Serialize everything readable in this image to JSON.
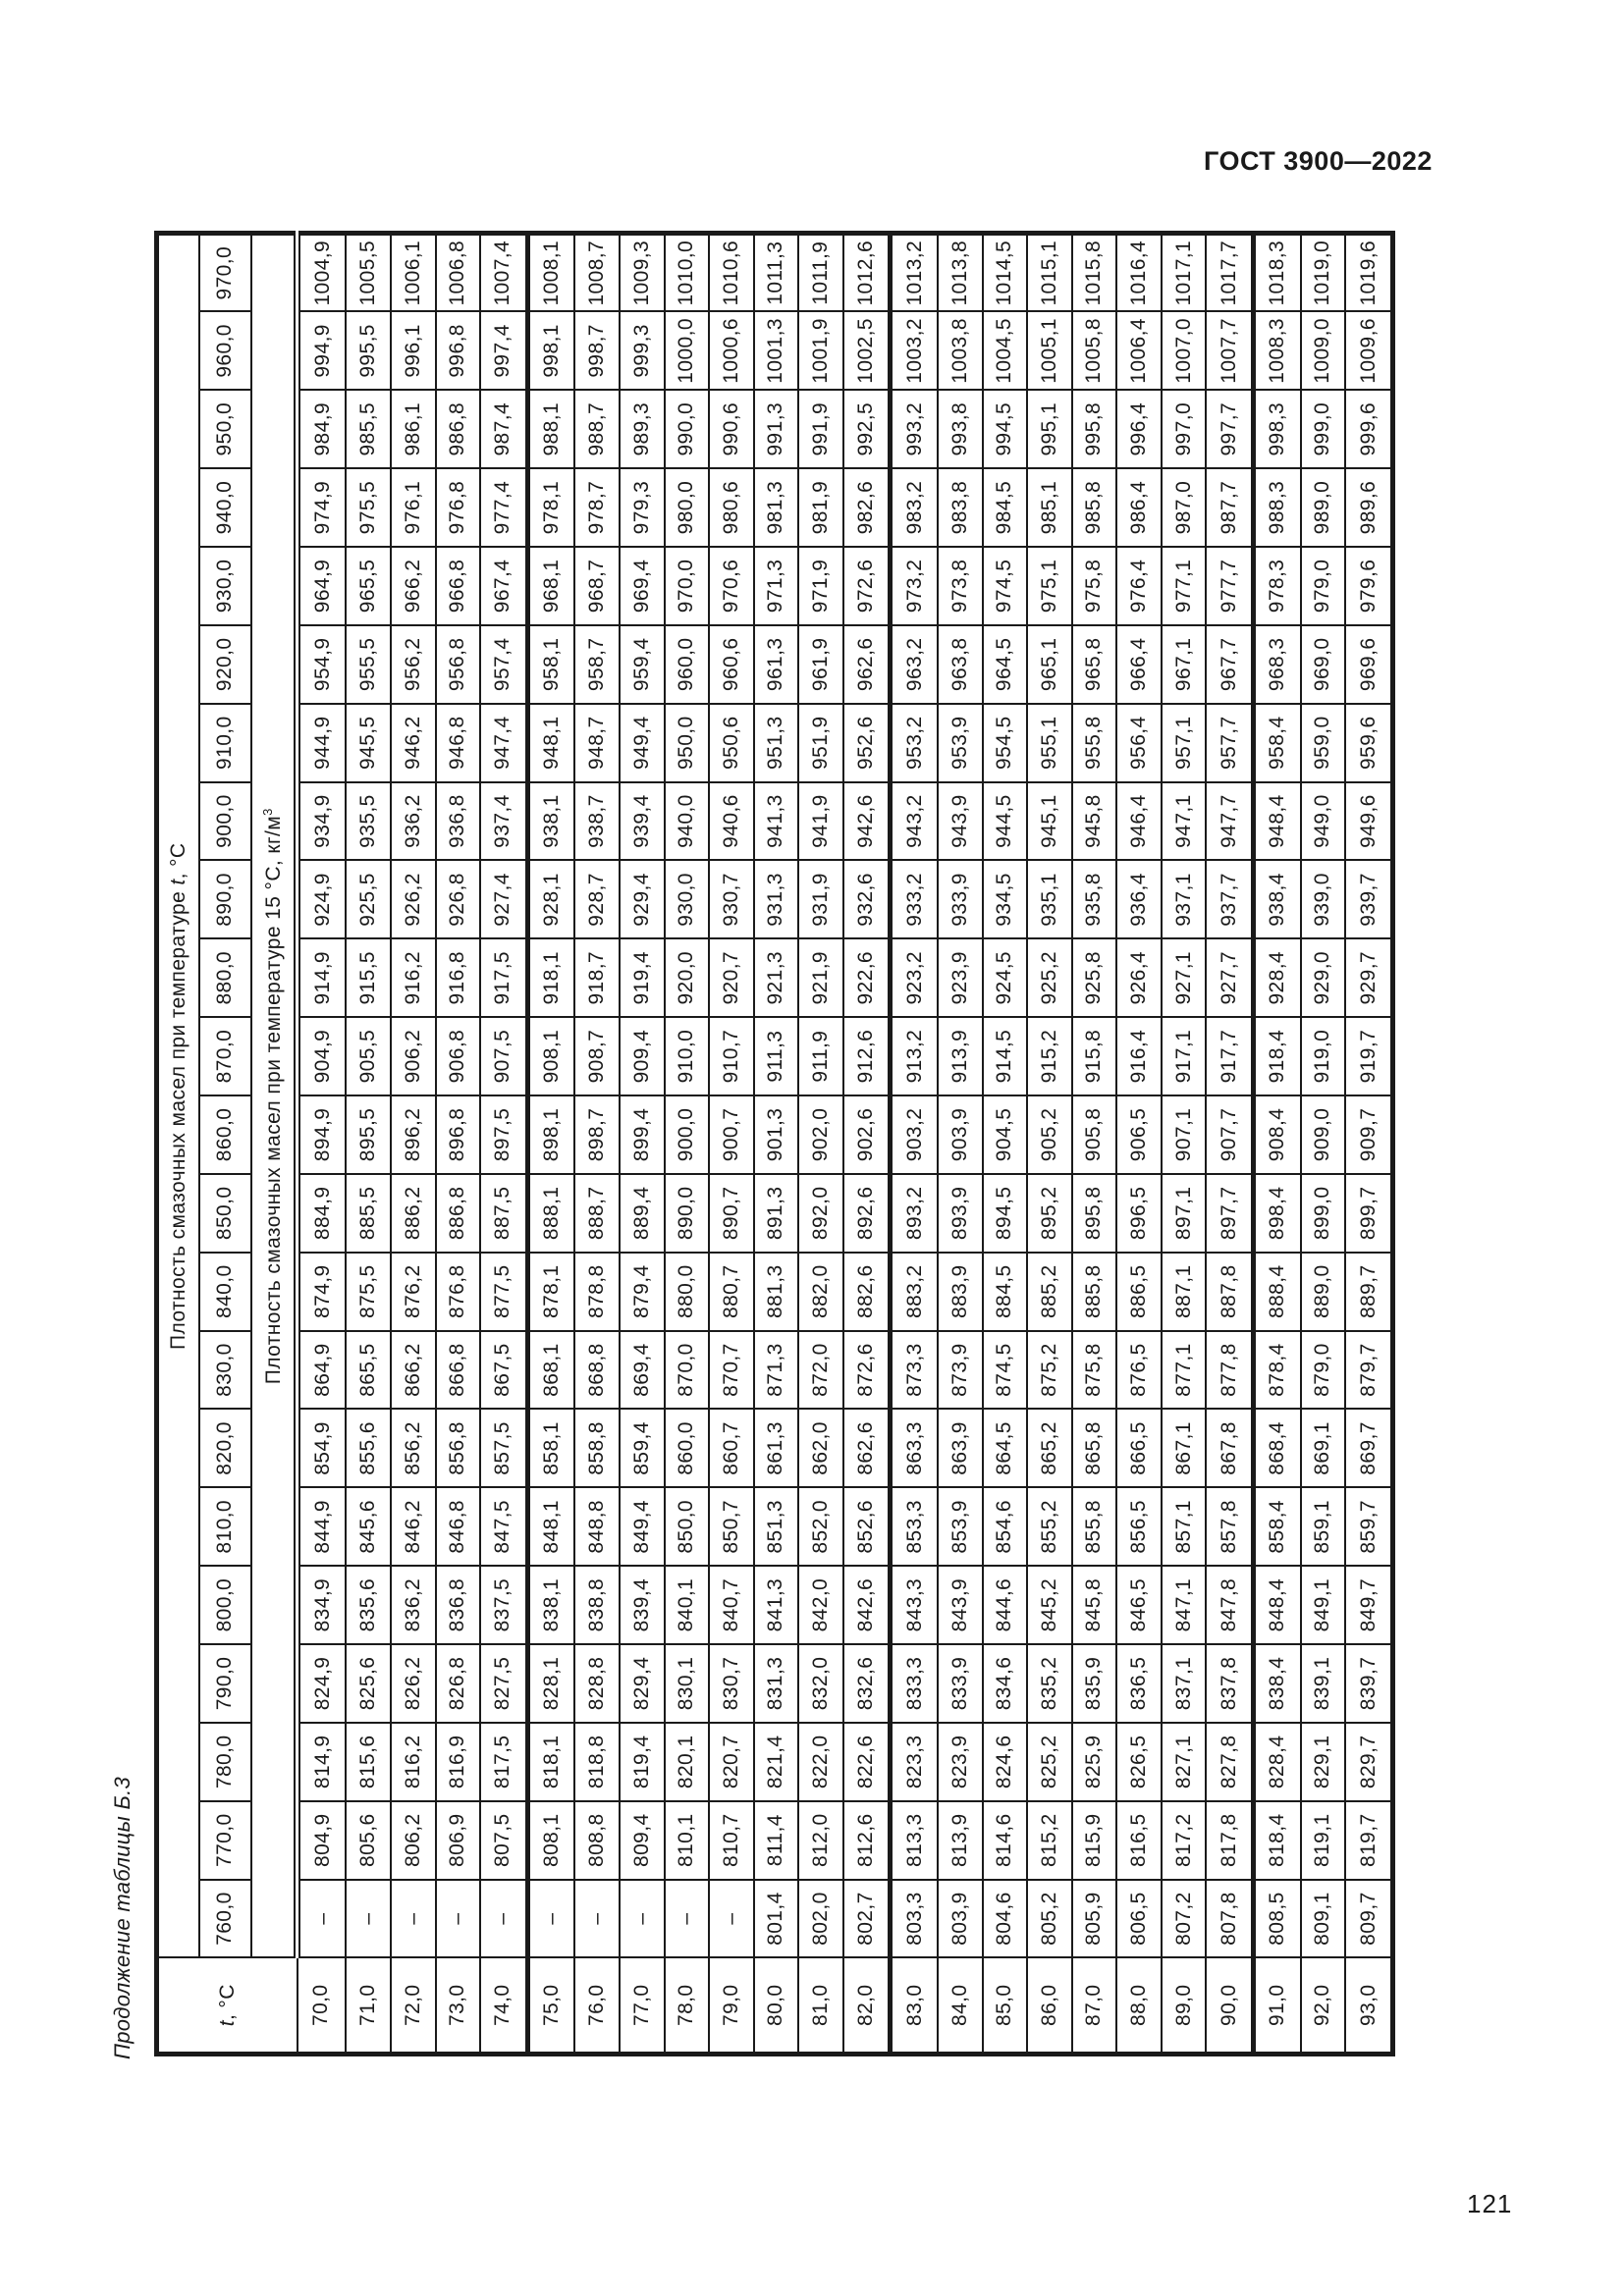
{
  "page": {
    "designation": "ГОСТ 3900—2022",
    "continuation": "Продолжение таблицы Б.3",
    "page_number": "121"
  },
  "table": {
    "stub_t": "t",
    "stub_rest": ", °С",
    "header_top_prefix": "Плотность смазочных масел при температуре ",
    "header_top_t": "t",
    "header_top_suffix": ", °С",
    "header_bottom_text": "Плотность смазочных масел при температуре 15 °С, кг/м",
    "header_bottom_sup": "3",
    "density_columns": [
      "760,0",
      "770,0",
      "780,0",
      "790,0",
      "800,0",
      "810,0",
      "820,0",
      "830,0",
      "840,0",
      "850,0",
      "860,0",
      "870,0",
      "880,0",
      "890,0",
      "900,0",
      "910,0",
      "920,0",
      "930,0",
      "940,0",
      "950,0",
      "960,0",
      "970,0"
    ],
    "rows": [
      {
        "t": "70,0",
        "values": [
          "–",
          "804,9",
          "814,9",
          "824,9",
          "834,9",
          "844,9",
          "854,9",
          "864,9",
          "874,9",
          "884,9",
          "894,9",
          "904,9",
          "914,9",
          "924,9",
          "934,9",
          "944,9",
          "954,9",
          "964,9",
          "974,9",
          "984,9",
          "994,9",
          "1004,9"
        ]
      },
      {
        "t": "71,0",
        "values": [
          "–",
          "805,6",
          "815,6",
          "825,6",
          "835,6",
          "845,6",
          "855,6",
          "865,5",
          "875,5",
          "885,5",
          "895,5",
          "905,5",
          "915,5",
          "925,5",
          "935,5",
          "945,5",
          "955,5",
          "965,5",
          "975,5",
          "985,5",
          "995,5",
          "1005,5"
        ]
      },
      {
        "t": "72,0",
        "values": [
          "–",
          "806,2",
          "816,2",
          "826,2",
          "836,2",
          "846,2",
          "856,2",
          "866,2",
          "876,2",
          "886,2",
          "896,2",
          "906,2",
          "916,2",
          "926,2",
          "936,2",
          "946,2",
          "956,2",
          "966,2",
          "976,1",
          "986,1",
          "996,1",
          "1006,1"
        ]
      },
      {
        "t": "73,0",
        "values": [
          "–",
          "806,9",
          "816,9",
          "826,8",
          "836,8",
          "846,8",
          "856,8",
          "866,8",
          "876,8",
          "886,8",
          "896,8",
          "906,8",
          "916,8",
          "926,8",
          "936,8",
          "946,8",
          "956,8",
          "966,8",
          "976,8",
          "986,8",
          "996,8",
          "1006,8"
        ]
      },
      {
        "t": "74,0",
        "values": [
          "–",
          "807,5",
          "817,5",
          "827,5",
          "837,5",
          "847,5",
          "857,5",
          "867,5",
          "877,5",
          "887,5",
          "897,5",
          "907,5",
          "917,5",
          "927,4",
          "937,4",
          "947,4",
          "957,4",
          "967,4",
          "977,4",
          "987,4",
          "997,4",
          "1007,4"
        ]
      },
      {
        "t": "75,0",
        "values": [
          "–",
          "808,1",
          "818,1",
          "828,1",
          "838,1",
          "848,1",
          "858,1",
          "868,1",
          "878,1",
          "888,1",
          "898,1",
          "908,1",
          "918,1",
          "928,1",
          "938,1",
          "948,1",
          "958,1",
          "968,1",
          "978,1",
          "988,1",
          "998,1",
          "1008,1"
        ]
      },
      {
        "t": "76,0",
        "values": [
          "–",
          "808,8",
          "818,8",
          "828,8",
          "838,8",
          "848,8",
          "858,8",
          "868,8",
          "878,8",
          "888,7",
          "898,7",
          "908,7",
          "918,7",
          "928,7",
          "938,7",
          "948,7",
          "958,7",
          "968,7",
          "978,7",
          "988,7",
          "998,7",
          "1008,7"
        ]
      },
      {
        "t": "77,0",
        "values": [
          "–",
          "809,4",
          "819,4",
          "829,4",
          "839,4",
          "849,4",
          "859,4",
          "869,4",
          "879,4",
          "889,4",
          "899,4",
          "909,4",
          "919,4",
          "929,4",
          "939,4",
          "949,4",
          "959,4",
          "969,4",
          "979,3",
          "989,3",
          "999,3",
          "1009,3"
        ]
      },
      {
        "t": "78,0",
        "values": [
          "–",
          "810,1",
          "820,1",
          "830,1",
          "840,1",
          "850,0",
          "860,0",
          "870,0",
          "880,0",
          "890,0",
          "900,0",
          "910,0",
          "920,0",
          "930,0",
          "940,0",
          "950,0",
          "960,0",
          "970,0",
          "980,0",
          "990,0",
          "1000,0",
          "1010,0"
        ]
      },
      {
        "t": "79,0",
        "values": [
          "–",
          "810,7",
          "820,7",
          "830,7",
          "840,7",
          "850,7",
          "860,7",
          "870,7",
          "880,7",
          "890,7",
          "900,7",
          "910,7",
          "920,7",
          "930,7",
          "940,6",
          "950,6",
          "960,6",
          "970,6",
          "980,6",
          "990,6",
          "1000,6",
          "1010,6"
        ]
      },
      {
        "t": "80,0",
        "values": [
          "801,4",
          "811,4",
          "821,4",
          "831,3",
          "841,3",
          "851,3",
          "861,3",
          "871,3",
          "881,3",
          "891,3",
          "901,3",
          "911,3",
          "921,3",
          "931,3",
          "941,3",
          "951,3",
          "961,3",
          "971,3",
          "981,3",
          "991,3",
          "1001,3",
          "1011,3"
        ]
      },
      {
        "t": "81,0",
        "values": [
          "802,0",
          "812,0",
          "822,0",
          "832,0",
          "842,0",
          "852,0",
          "862,0",
          "872,0",
          "882,0",
          "892,0",
          "902,0",
          "911,9",
          "921,9",
          "931,9",
          "941,9",
          "951,9",
          "961,9",
          "971,9",
          "981,9",
          "991,9",
          "1001,9",
          "1011,9"
        ]
      },
      {
        "t": "82,0",
        "values": [
          "802,7",
          "812,6",
          "822,6",
          "832,6",
          "842,6",
          "852,6",
          "862,6",
          "872,6",
          "882,6",
          "892,6",
          "902,6",
          "912,6",
          "922,6",
          "932,6",
          "942,6",
          "952,6",
          "962,6",
          "972,6",
          "982,6",
          "992,5",
          "1002,5",
          "1012,6"
        ]
      },
      {
        "t": "83,0",
        "values": [
          "803,3",
          "813,3",
          "823,3",
          "833,3",
          "843,3",
          "853,3",
          "863,3",
          "873,3",
          "883,2",
          "893,2",
          "903,2",
          "913,2",
          "923,2",
          "933,2",
          "943,2",
          "953,2",
          "963,2",
          "973,2",
          "983,2",
          "993,2",
          "1003,2",
          "1013,2"
        ]
      },
      {
        "t": "84,0",
        "values": [
          "803,9",
          "813,9",
          "823,9",
          "833,9",
          "843,9",
          "853,9",
          "863,9",
          "873,9",
          "883,9",
          "893,9",
          "903,9",
          "913,9",
          "923,9",
          "933,9",
          "943,9",
          "953,9",
          "963,8",
          "973,8",
          "983,8",
          "993,8",
          "1003,8",
          "1013,8"
        ]
      },
      {
        "t": "85,0",
        "values": [
          "804,6",
          "814,6",
          "824,6",
          "834,6",
          "844,6",
          "854,6",
          "864,5",
          "874,5",
          "884,5",
          "894,5",
          "904,5",
          "914,5",
          "924,5",
          "934,5",
          "944,5",
          "954,5",
          "964,5",
          "974,5",
          "984,5",
          "994,5",
          "1004,5",
          "1014,5"
        ]
      },
      {
        "t": "86,0",
        "values": [
          "805,2",
          "815,2",
          "825,2",
          "835,2",
          "845,2",
          "855,2",
          "865,2",
          "875,2",
          "885,2",
          "895,2",
          "905,2",
          "915,2",
          "925,2",
          "935,1",
          "945,1",
          "955,1",
          "965,1",
          "975,1",
          "985,1",
          "995,1",
          "1005,1",
          "1015,1"
        ]
      },
      {
        "t": "87,0",
        "values": [
          "805,9",
          "815,9",
          "825,9",
          "835,9",
          "845,8",
          "855,8",
          "865,8",
          "875,8",
          "885,8",
          "895,8",
          "905,8",
          "915,8",
          "925,8",
          "935,8",
          "945,8",
          "955,8",
          "965,8",
          "975,8",
          "985,8",
          "995,8",
          "1005,8",
          "1015,8"
        ]
      },
      {
        "t": "88,0",
        "values": [
          "806,5",
          "816,5",
          "826,5",
          "836,5",
          "846,5",
          "856,5",
          "866,5",
          "876,5",
          "886,5",
          "896,5",
          "906,5",
          "916,4",
          "926,4",
          "936,4",
          "946,4",
          "956,4",
          "966,4",
          "976,4",
          "986,4",
          "996,4",
          "1006,4",
          "1016,4"
        ]
      },
      {
        "t": "89,0",
        "values": [
          "807,2",
          "817,2",
          "827,1",
          "837,1",
          "847,1",
          "857,1",
          "867,1",
          "877,1",
          "887,1",
          "897,1",
          "907,1",
          "917,1",
          "927,1",
          "937,1",
          "947,1",
          "957,1",
          "967,1",
          "977,1",
          "987,0",
          "997,0",
          "1007,0",
          "1017,1"
        ]
      },
      {
        "t": "90,0",
        "values": [
          "807,8",
          "817,8",
          "827,8",
          "837,8",
          "847,8",
          "857,8",
          "867,8",
          "877,8",
          "887,8",
          "897,7",
          "907,7",
          "917,7",
          "927,7",
          "937,7",
          "947,7",
          "957,7",
          "967,7",
          "977,7",
          "987,7",
          "997,7",
          "1007,7",
          "1017,7"
        ]
      },
      {
        "t": "91,0",
        "values": [
          "808,5",
          "818,4",
          "828,4",
          "838,4",
          "848,4",
          "858,4",
          "868,4",
          "878,4",
          "888,4",
          "898,4",
          "908,4",
          "918,4",
          "928,4",
          "938,4",
          "948,4",
          "958,4",
          "968,3",
          "978,3",
          "988,3",
          "998,3",
          "1008,3",
          "1018,3"
        ]
      },
      {
        "t": "92,0",
        "values": [
          "809,1",
          "819,1",
          "829,1",
          "839,1",
          "849,1",
          "859,1",
          "869,1",
          "879,0",
          "889,0",
          "899,0",
          "909,0",
          "919,0",
          "929,0",
          "939,0",
          "949,0",
          "959,0",
          "969,0",
          "979,0",
          "989,0",
          "999,0",
          "1009,0",
          "1019,0"
        ]
      },
      {
        "t": "93,0",
        "values": [
          "809,7",
          "819,7",
          "829,7",
          "839,7",
          "849,7",
          "859,7",
          "869,7",
          "879,7",
          "889,7",
          "899,7",
          "909,7",
          "919,7",
          "929,7",
          "939,7",
          "949,6",
          "959,6",
          "969,6",
          "979,6",
          "989,6",
          "999,6",
          "1009,6",
          "1019,6"
        ]
      }
    ]
  }
}
